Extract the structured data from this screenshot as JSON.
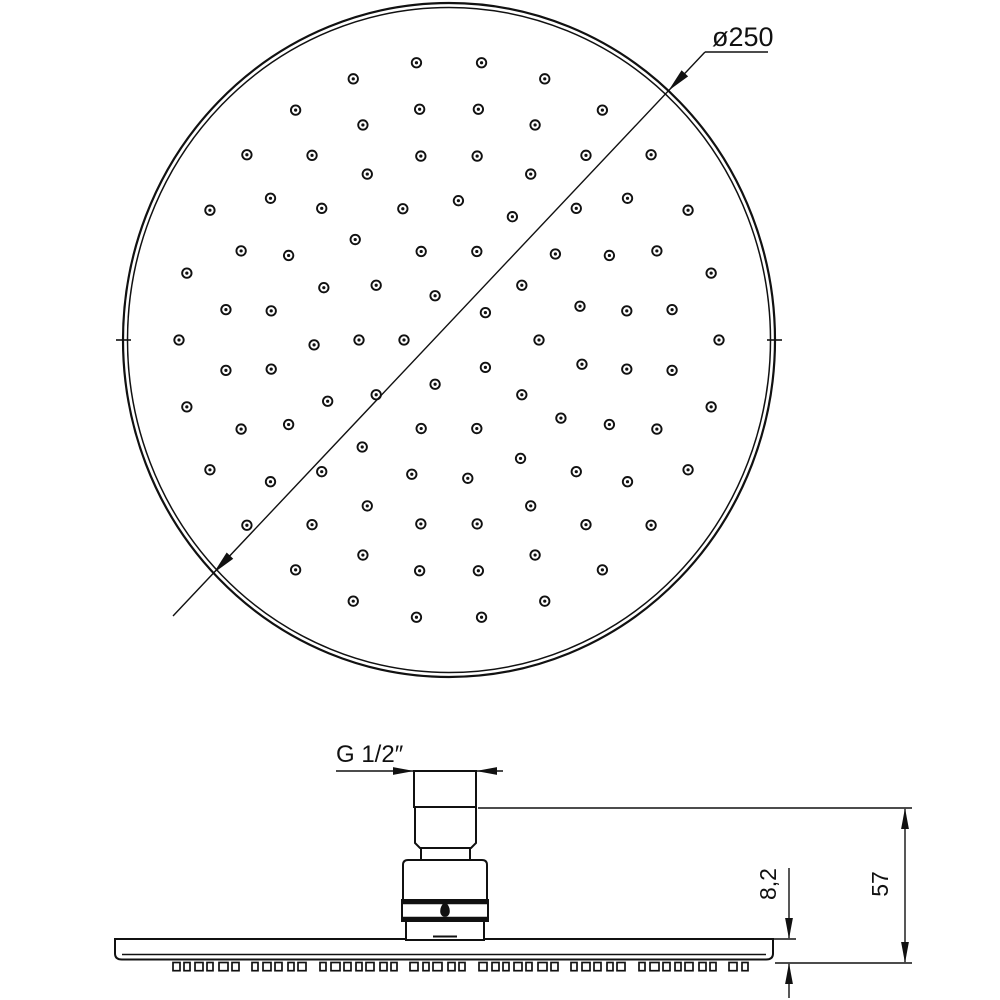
{
  "title": "Shower head technical drawing",
  "labels": {
    "diameter": "ø250",
    "thread": "G 1/2″",
    "plate_thickness": "8,2",
    "total_height": "57"
  },
  "colors": {
    "background": "#ffffff",
    "line": "#111111"
  },
  "face_view": {
    "cx": 449,
    "cy": 340,
    "rx_outer": 326,
    "ry_outer": 337,
    "rx_inner": 321.5,
    "ry_inner": 332.5,
    "edge_ticks": [
      {
        "x1": 116,
        "y1": 340,
        "x2": 131,
        "y2": 340
      },
      {
        "x1": 767,
        "y1": 340,
        "x2": 782,
        "y2": 340
      }
    ],
    "nozzle": {
      "outer_r": 4.7,
      "outer_stroke": 1.9,
      "dot_r": 1.6,
      "v_scale": 1.0345
    },
    "rings": [
      {
        "r": 45,
        "count": 5,
        "offset": 36
      },
      {
        "r": 90,
        "count": 10,
        "offset": 0
      },
      {
        "r": 135,
        "count": 15,
        "offset": 10
      },
      {
        "r": 180,
        "count": 20,
        "offset": 9
      },
      {
        "r": 225,
        "count": 24,
        "offset": 7.5
      },
      {
        "r": 270,
        "count": 26,
        "offset": 0
      }
    ],
    "diameter_dim": {
      "leader": [
        [
          173,
          616
        ],
        [
          705,
          52
        ],
        [
          768,
          52
        ]
      ],
      "arrows": [
        {
          "x": 213.5,
          "y": 573.1,
          "angle": 133.3,
          "len": 24,
          "hw": 4.5
        },
        {
          "x": 668.4,
          "y": 90.8,
          "angle": 133.3,
          "len": 24,
          "hw": 4.5
        }
      ],
      "label": {
        "key": "diameter",
        "x": 712,
        "y": 46,
        "fs": 27,
        "anchor": "start",
        "rot": 0
      }
    }
  },
  "side_view": {
    "parts": [
      {
        "type": "path",
        "name": "plate",
        "d": "M115,939 L773,939 L773,953.5 Q773,959.5 766,959.5 L122,959.5 Q115,959.5 115,953.5 Z"
      },
      {
        "type": "line",
        "name": "plate-lip",
        "x1": 122,
        "y1": 954.5,
        "x2": 766,
        "y2": 954.5,
        "sw": 1.5
      },
      {
        "type": "rect",
        "name": "thread-pipe",
        "x": 414,
        "y": 771,
        "w": 62,
        "h": 36
      },
      {
        "type": "polygon",
        "name": "upper-cylinder",
        "points": "415,807 476,807 476,843 471,848 420,848 415,843"
      },
      {
        "type": "rect",
        "name": "neck",
        "x": 421,
        "y": 848,
        "w": 49,
        "h": 12
      },
      {
        "type": "path",
        "name": "nut-body",
        "d": "M403,900 L403,865 Q403,860 408,860 L482,860 Q487,860 487,865 L487,900 Z"
      },
      {
        "type": "rect",
        "name": "band",
        "x": 402,
        "y": 900,
        "w": 86,
        "h": 21
      },
      {
        "type": "line",
        "name": "band-top-edge",
        "x1": 402,
        "y1": 902.6,
        "x2": 488,
        "y2": 902.6,
        "sw": 3.4
      },
      {
        "type": "line",
        "name": "band-bottom-edge",
        "x1": 402,
        "y1": 918.4,
        "x2": 488,
        "y2": 918.4,
        "sw": 3.4
      },
      {
        "type": "path",
        "name": "drop-hole",
        "d": "M445,901.5 C447.8,905.5 449.3,907.6 449.3,911 C449.3,914.4 447.4,916.4 445,916.4 C442.6,916.4 440.7,914.4 440.7,911 C440.7,907.6 442.2,905.5 445,901.5 Z",
        "fill": true
      },
      {
        "type": "rect",
        "name": "collar",
        "x": 406,
        "y": 921,
        "w": 78,
        "h": 19
      },
      {
        "type": "line",
        "name": "inlet-notch",
        "x1": 433,
        "y1": 936.5,
        "x2": 457,
        "y2": 936.5,
        "sw": 2
      }
    ],
    "teeth": {
      "y": 962.5,
      "h": 8.2,
      "x_start": 173,
      "x_end": 752,
      "widths": [
        7,
        6,
        8,
        6,
        9,
        7,
        6,
        8
      ],
      "gaps": [
        4,
        5,
        4,
        6,
        4,
        13,
        5,
        4,
        6,
        4,
        14,
        5
      ],
      "stroke": 1.7
    },
    "dim_lines": [
      {
        "x1": 336,
        "y1": 771,
        "x2": 413,
        "y2": 771
      },
      {
        "x1": 477,
        "y1": 771,
        "x2": 503,
        "y2": 771
      },
      {
        "x1": 478,
        "y1": 808,
        "x2": 912,
        "y2": 808
      },
      {
        "x1": 775,
        "y1": 963,
        "x2": 912,
        "y2": 963
      },
      {
        "x1": 773,
        "y1": 939,
        "x2": 796,
        "y2": 939
      },
      {
        "x1": 789,
        "y1": 868,
        "x2": 789,
        "y2": 938
      },
      {
        "x1": 789,
        "y1": 964,
        "x2": 789,
        "y2": 998
      },
      {
        "x1": 905,
        "y1": 809,
        "x2": 905,
        "y2": 962
      }
    ],
    "arrows": [
      {
        "x": 414,
        "y": 771,
        "angle": 0
      },
      {
        "x": 476,
        "y": 771,
        "angle": 180
      },
      {
        "x": 905,
        "y": 808,
        "angle": -90
      },
      {
        "x": 905,
        "y": 963,
        "angle": 90
      },
      {
        "x": 789,
        "y": 939,
        "angle": 90
      },
      {
        "x": 789,
        "y": 963,
        "angle": -90
      }
    ],
    "labels": [
      {
        "key": "thread",
        "x": 336,
        "y": 762,
        "fs": 24,
        "anchor": "start",
        "rot": 0
      },
      {
        "key": "plate_thickness",
        "x": 776,
        "y": 884,
        "fs": 23,
        "anchor": "middle",
        "rot": -90
      },
      {
        "key": "total_height",
        "x": 888,
        "y": 884,
        "fs": 23,
        "anchor": "middle",
        "rot": -90
      }
    ]
  }
}
